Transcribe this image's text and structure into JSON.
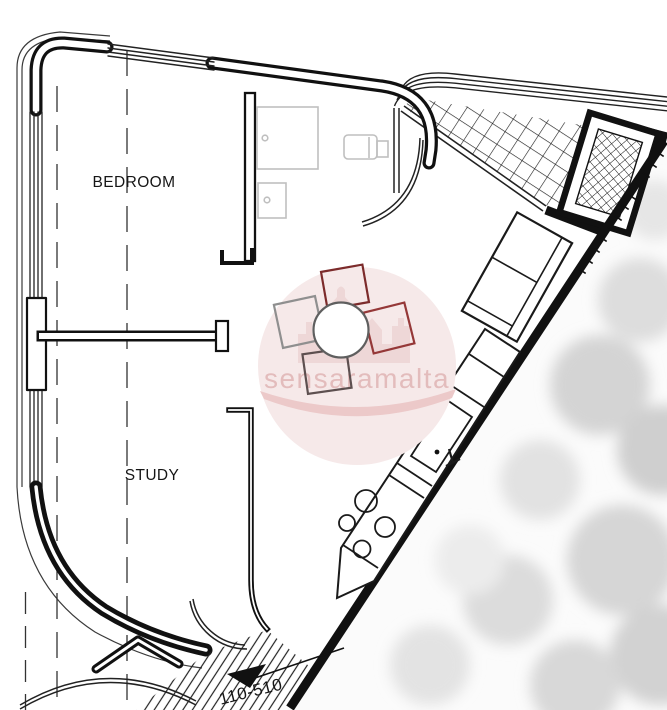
{
  "title": "Apartment floor plan",
  "labels": {
    "bedroom": "BEDROOM",
    "study": "STUDY",
    "unit": "110-510"
  },
  "watermark": {
    "text": "sensaramalta",
    "circle_color": "#f6e9e9",
    "castle_color": "#eed7d7",
    "swoosh_color": "#ecc9c9",
    "text_color": "#e3bcbc"
  },
  "colors": {
    "wall": "#111111",
    "furniture_gray": "#bfbfbf",
    "table_stroke": "#5f5f5f",
    "chair_top": "#7c2b2b",
    "chair_right": "#953838",
    "chair_left": "#8f8f8f",
    "chair_bottom": "#5d4f4f"
  }
}
